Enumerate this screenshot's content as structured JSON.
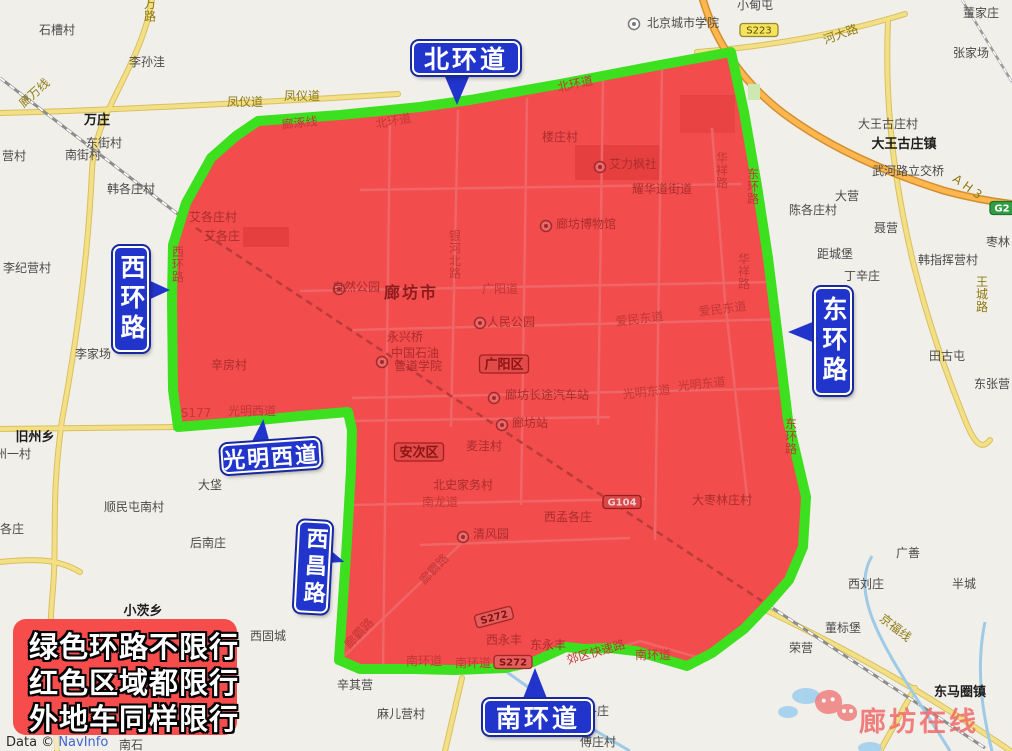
{
  "colors": {
    "ring_green": "#3ce01e",
    "zone_red": "#f24c4c",
    "sign_blue": "#2135cc",
    "notice_red": "#f64c4c",
    "highway_orange": "#ffb64f",
    "road_yellow": "#f3df85",
    "water_blue": "#9fcae6",
    "watermark_pink": "#ef6b6b"
  },
  "signs": {
    "north": "北环道",
    "west": "西环路",
    "east": "东环路",
    "gmw": "光明西道",
    "xc": "西昌路",
    "south": "南环道"
  },
  "legend_box": {
    "lines": [
      "绿色环路不限行",
      "红色区域都限行",
      "外地车同样限行"
    ]
  },
  "watermark": {
    "text": "廊坊在线"
  },
  "attribution": {
    "prefix": "Data © ",
    "provider": "NavInfo"
  },
  "map": {
    "labels": [
      {
        "t": "石槽村",
        "x": 57,
        "y": 34,
        "c": "v"
      },
      {
        "t": "李孙洼",
        "x": 147,
        "y": 66,
        "c": "v"
      },
      {
        "t": "万庄",
        "x": 97,
        "y": 124,
        "c": "t"
      },
      {
        "t": "东街村",
        "x": 104,
        "y": 147,
        "c": "v"
      },
      {
        "t": "南街村",
        "x": 83,
        "y": 159,
        "c": "v"
      },
      {
        "t": "韩各庄村",
        "x": 131,
        "y": 193,
        "c": "v"
      },
      {
        "t": "营村",
        "x": 14,
        "y": 160,
        "c": "v"
      },
      {
        "t": "李纪营村",
        "x": 27,
        "y": 272,
        "c": "v"
      },
      {
        "t": "李家场",
        "x": 93,
        "y": 358,
        "c": "v"
      },
      {
        "t": "旧州乡",
        "x": 35,
        "y": 441,
        "c": "t"
      },
      {
        "t": "州一村",
        "x": 13,
        "y": 458,
        "c": "v"
      },
      {
        "t": "各庄",
        "x": 12,
        "y": 533,
        "c": "v"
      },
      {
        "t": "大垡",
        "x": 210,
        "y": 489,
        "c": "v"
      },
      {
        "t": "顺民屯南村",
        "x": 134,
        "y": 511,
        "c": "v"
      },
      {
        "t": "后南庄",
        "x": 208,
        "y": 547,
        "c": "v"
      },
      {
        "t": "小茨乡",
        "x": 143,
        "y": 615,
        "c": "t"
      },
      {
        "t": "西固城",
        "x": 268,
        "y": 640,
        "c": "v"
      },
      {
        "t": "辛其营",
        "x": 355,
        "y": 689,
        "c": "v"
      },
      {
        "t": "麻儿营村",
        "x": 401,
        "y": 718,
        "c": "v"
      },
      {
        "t": "南石",
        "x": 131,
        "y": 749,
        "c": "v"
      },
      {
        "t": "傅庄村",
        "x": 598,
        "y": 746,
        "c": "v"
      },
      {
        "t": "各庄",
        "x": 597,
        "y": 715,
        "c": "v"
      },
      {
        "t": "小甸屯",
        "x": 755,
        "y": 9,
        "c": "v"
      },
      {
        "t": "董家庄",
        "x": 981,
        "y": 17,
        "c": "v"
      },
      {
        "t": "张家场",
        "x": 971,
        "y": 57,
        "c": "v"
      },
      {
        "t": "北京城市学院",
        "x": 683,
        "y": 27,
        "c": "v"
      },
      {
        "t": "大王古庄村",
        "x": 888,
        "y": 128,
        "c": "v"
      },
      {
        "t": "大王古庄镇",
        "x": 904,
        "y": 148,
        "c": "t"
      },
      {
        "t": "武河路立交桥",
        "x": 908,
        "y": 175,
        "c": "v"
      },
      {
        "t": "大营",
        "x": 847,
        "y": 200,
        "c": "v"
      },
      {
        "t": "陈各庄村",
        "x": 813,
        "y": 214,
        "c": "v"
      },
      {
        "t": "聂营",
        "x": 886,
        "y": 232,
        "c": "v"
      },
      {
        "t": "枣林",
        "x": 998,
        "y": 246,
        "c": "v"
      },
      {
        "t": "距城堡",
        "x": 835,
        "y": 258,
        "c": "v"
      },
      {
        "t": "韩指挥营村",
        "x": 948,
        "y": 264,
        "c": "v"
      },
      {
        "t": "丁辛庄",
        "x": 862,
        "y": 280,
        "c": "v"
      },
      {
        "t": "田古屯",
        "x": 947,
        "y": 360,
        "c": "v"
      },
      {
        "t": "东张营",
        "x": 992,
        "y": 388,
        "c": "v"
      },
      {
        "t": "广善",
        "x": 908,
        "y": 557,
        "c": "v"
      },
      {
        "t": "西刘庄",
        "x": 866,
        "y": 588,
        "c": "v"
      },
      {
        "t": "半城",
        "x": 964,
        "y": 588,
        "c": "v"
      },
      {
        "t": "董标堡",
        "x": 843,
        "y": 632,
        "c": "v"
      },
      {
        "t": "荣营",
        "x": 801,
        "y": 652,
        "c": "v"
      },
      {
        "t": "东马圈镇",
        "x": 960,
        "y": 696,
        "c": "t"
      },
      {
        "t": "凤仪道",
        "x": 245,
        "y": 106,
        "c": "r"
      },
      {
        "t": "凤仪道",
        "x": 302,
        "y": 100,
        "c": "r"
      },
      {
        "t": "廊万线",
        "x": 37,
        "y": 96,
        "c": "r",
        "r": -42
      },
      {
        "t": "万路",
        "x": 150,
        "y": 8,
        "c": "r",
        "vert": true
      },
      {
        "t": "河大路",
        "x": 842,
        "y": 38,
        "c": "r",
        "r": -20
      },
      {
        "t": "京福线",
        "x": 893,
        "y": 631,
        "c": "r",
        "r": 38
      },
      {
        "t": "王城路",
        "x": 982,
        "y": 286,
        "c": "r",
        "vert": true
      },
      {
        "t": "A H 3",
        "x": 965,
        "y": 190,
        "c": "r",
        "r": 36
      },
      {
        "t": "廊涿线",
        "x": 300,
        "y": 127,
        "c": "rr",
        "r": -6
      },
      {
        "t": "北环道",
        "x": 394,
        "y": 125,
        "c": "rr",
        "r": -10
      },
      {
        "t": "北环道",
        "x": 576,
        "y": 88,
        "c": "rr",
        "r": -12
      },
      {
        "t": "银河北路",
        "x": 455,
        "y": 240,
        "c": "rr",
        "vert": true
      },
      {
        "t": "广阳道",
        "x": 500,
        "y": 293,
        "c": "rr"
      },
      {
        "t": "爱民东道",
        "x": 640,
        "y": 323,
        "c": "rr",
        "r": -7
      },
      {
        "t": "爱民东道",
        "x": 723,
        "y": 313,
        "c": "rr",
        "r": -7
      },
      {
        "t": "光明东道",
        "x": 647,
        "y": 396,
        "c": "rr",
        "r": -6
      },
      {
        "t": "光明东道",
        "x": 702,
        "y": 388,
        "c": "rr",
        "r": -6
      },
      {
        "t": "S177",
        "x": 196,
        "y": 417,
        "c": "rr"
      },
      {
        "t": "光明西道",
        "x": 252,
        "y": 415,
        "c": "rr"
      },
      {
        "t": "南龙道",
        "x": 440,
        "y": 506,
        "c": "rr"
      },
      {
        "t": "廊霸路",
        "x": 437,
        "y": 572,
        "c": "rr",
        "r": -47
      },
      {
        "t": "廊霸路",
        "x": 362,
        "y": 636,
        "c": "rr",
        "r": -47
      },
      {
        "t": "南环道",
        "x": 424,
        "y": 665,
        "c": "rr"
      },
      {
        "t": "南环道",
        "x": 473,
        "y": 667,
        "c": "rr"
      },
      {
        "t": "南环道",
        "x": 653,
        "y": 659,
        "c": "rr"
      },
      {
        "t": "郊区快速路",
        "x": 597,
        "y": 656,
        "c": "rr",
        "r": -16
      },
      {
        "t": "华祥路",
        "x": 722,
        "y": 162,
        "c": "rr",
        "vert": true
      },
      {
        "t": "华祥路",
        "x": 744,
        "y": 263,
        "c": "rr",
        "vert": true
      },
      {
        "t": "东环路",
        "x": 753,
        "y": 178,
        "c": "rr",
        "vert": true
      },
      {
        "t": "东环路",
        "x": 791,
        "y": 428,
        "c": "rr",
        "vert": true
      },
      {
        "t": "西环路",
        "x": 178,
        "y": 256,
        "c": "rr",
        "vert": true
      },
      {
        "t": "耀华道街道",
        "x": 662,
        "y": 193,
        "c": "rv"
      },
      {
        "t": "艾各庄村",
        "x": 213,
        "y": 221,
        "c": "rv"
      },
      {
        "t": "艾各庄",
        "x": 222,
        "y": 240,
        "c": "rv"
      },
      {
        "t": "辛房村",
        "x": 229,
        "y": 369,
        "c": "rv"
      },
      {
        "t": "楼庄村",
        "x": 560,
        "y": 141,
        "c": "rv"
      },
      {
        "t": "艾力枫社",
        "x": 633,
        "y": 168,
        "c": "rv"
      },
      {
        "t": "廊坊博物馆",
        "x": 586,
        "y": 228,
        "c": "rv"
      },
      {
        "t": "自然公园",
        "x": 356,
        "y": 291,
        "c": "rv"
      },
      {
        "t": "人民公园",
        "x": 511,
        "y": 326,
        "c": "rv"
      },
      {
        "t": "永兴桥",
        "x": 405,
        "y": 341,
        "c": "rv"
      },
      {
        "t": "中国石油",
        "x": 415,
        "y": 357,
        "c": "rv"
      },
      {
        "t": "管道学院",
        "x": 418,
        "y": 370,
        "c": "rv"
      },
      {
        "t": "麦洼村",
        "x": 484,
        "y": 450,
        "c": "rv"
      },
      {
        "t": "北史家务村",
        "x": 463,
        "y": 489,
        "c": "rv"
      },
      {
        "t": "清风园",
        "x": 491,
        "y": 538,
        "c": "rv"
      },
      {
        "t": "西孟各庄",
        "x": 568,
        "y": 521,
        "c": "rv"
      },
      {
        "t": "西永丰",
        "x": 504,
        "y": 644,
        "c": "rv"
      },
      {
        "t": "东永丰",
        "x": 548,
        "y": 649,
        "c": "rv"
      },
      {
        "t": "大枣林庄村",
        "x": 722,
        "y": 504,
        "c": "rv"
      },
      {
        "t": "廊坊长途汽车站",
        "x": 547,
        "y": 399,
        "c": "rv"
      },
      {
        "t": "廊坊站",
        "x": 530,
        "y": 427,
        "c": "rv"
      },
      {
        "t": "廊坊市",
        "x": 411,
        "y": 298,
        "c": "rc"
      }
    ],
    "badges": [
      {
        "t": "S223",
        "x": 759,
        "y": 30,
        "c": "bs"
      },
      {
        "t": "G2",
        "x": 1002,
        "y": 208,
        "c": "bg"
      },
      {
        "t": "G104",
        "x": 622,
        "y": 502,
        "c": "bgr"
      },
      {
        "t": "S272",
        "x": 494,
        "y": 617,
        "c": "bsr",
        "r": -15
      },
      {
        "t": "S272",
        "x": 513,
        "y": 662,
        "c": "bsr"
      },
      {
        "t": "广阳区",
        "x": 504,
        "y": 364,
        "c": "bd"
      },
      {
        "t": "安次区",
        "x": 419,
        "y": 452,
        "c": "bd"
      }
    ],
    "pois": [
      {
        "x": 634,
        "y": 24,
        "k": "school",
        "zone": "base"
      },
      {
        "x": 600,
        "y": 167,
        "k": "attraction",
        "zone": "red"
      },
      {
        "x": 546,
        "y": 226,
        "k": "museum",
        "zone": "red"
      },
      {
        "x": 339,
        "y": 289,
        "k": "park",
        "zone": "red"
      },
      {
        "x": 480,
        "y": 323,
        "k": "park",
        "zone": "red"
      },
      {
        "x": 382,
        "y": 362,
        "k": "school",
        "zone": "red"
      },
      {
        "x": 494,
        "y": 398,
        "k": "bus-station",
        "zone": "red"
      },
      {
        "x": 502,
        "y": 425,
        "k": "train-station",
        "zone": "red"
      },
      {
        "x": 463,
        "y": 537,
        "k": "park",
        "zone": "red"
      }
    ]
  }
}
